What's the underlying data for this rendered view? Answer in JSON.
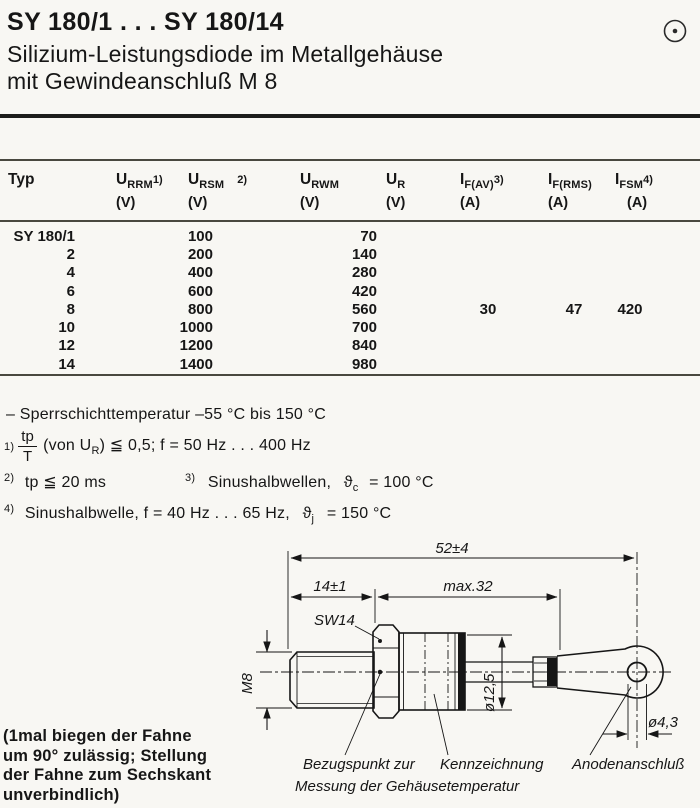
{
  "colors": {
    "ink": "#161616",
    "paper": "#f8f7f3"
  },
  "header": {
    "title": "SY 180/1 . . . SY 180/14",
    "subtitle_line1": "Silizium-Leistungsdiode im Metallgehäuse",
    "subtitle_line2": "mit Gewindeanschluß M 8",
    "corner_icon": "circled-dot"
  },
  "table": {
    "columns": [
      {
        "label": "Typ",
        "base": "Typ",
        "sub": "",
        "note": "",
        "unit": ""
      },
      {
        "base": "U",
        "sub": "RRM",
        "note": "1)",
        "unit": "(V)"
      },
      {
        "base": "U",
        "sub": "RSM",
        "note": "2)",
        "unit": "(V)"
      },
      {
        "base": "U",
        "sub": "RWM",
        "note": "",
        "unit": "(V)"
      },
      {
        "base": "U",
        "sub": "R",
        "note": "",
        "unit": "(V)"
      },
      {
        "base": "I",
        "sub": "F(AV)",
        "note": "3)",
        "unit": "(A)"
      },
      {
        "base": "I",
        "sub": "F(RMS)",
        "note": "",
        "unit": "(A)"
      },
      {
        "base": "I",
        "sub": "FSM",
        "note": "4)",
        "unit": "(A)"
      }
    ],
    "rows": [
      {
        "typ": "SY 180/1",
        "urrm_ursm": "100",
        "urwm_ur": "70"
      },
      {
        "typ": "2",
        "urrm_ursm": "200",
        "urwm_ur": "140"
      },
      {
        "typ": "4",
        "urrm_ursm": "400",
        "urwm_ur": "280"
      },
      {
        "typ": "6",
        "urrm_ursm": "600",
        "urwm_ur": "420"
      },
      {
        "typ": "8",
        "urrm_ursm": "800",
        "urwm_ur": "560"
      },
      {
        "typ": "10",
        "urrm_ursm": "1000",
        "urwm_ur": "700"
      },
      {
        "typ": "12",
        "urrm_ursm": "1200",
        "urwm_ur": "840"
      },
      {
        "typ": "14",
        "urrm_ursm": "1400",
        "urwm_ur": "980"
      }
    ],
    "shared_values": {
      "if_av": "30",
      "if_rms": "47",
      "ifsm": "420"
    }
  },
  "notes": {
    "temp_note": "–  Sperrschichttemperatur  –55 °C bis 150 °C",
    "fn1": {
      "marker": "1)",
      "num": "tp",
      "den": "T",
      "pre": "(von U",
      "sub": "R",
      "post": ") ≦ 0,5;  f = 50 Hz . . . 400 Hz"
    },
    "fn2": {
      "marker": "2)",
      "text": "tp ≦ 20 ms"
    },
    "fn3": {
      "marker": "3)",
      "pre": "Sinushalbwellen,",
      "theta": "ϑ",
      "sub": "c",
      "post": "= 100 °C"
    },
    "fn4": {
      "marker": "4)",
      "pre": "Sinushalbwelle,  f = 40 Hz . . . 65 Hz,",
      "theta": "ϑ",
      "sub": "j",
      "post": "= 150 °C"
    }
  },
  "drawing": {
    "dim_overall": "52±4",
    "dim_stud": "14±1",
    "dim_body": "max.32",
    "wrench_size": "SW14",
    "thread": "M8",
    "dia_body": "ø12,5",
    "dia_hole": "ø4,3",
    "label_ref_line1": "Bezugspunkt zur",
    "label_ref_line2": "Messung der Gehäusetemperatur",
    "label_marking": "Kennzeichnung",
    "label_anode": "Anodenanschluß"
  },
  "side_note": {
    "lines": [
      "(1mal biegen der Fahne",
      "um 90° zulässig; Stellung",
      "der Fahne zum Sechskant",
      "unverbindlich)"
    ]
  }
}
